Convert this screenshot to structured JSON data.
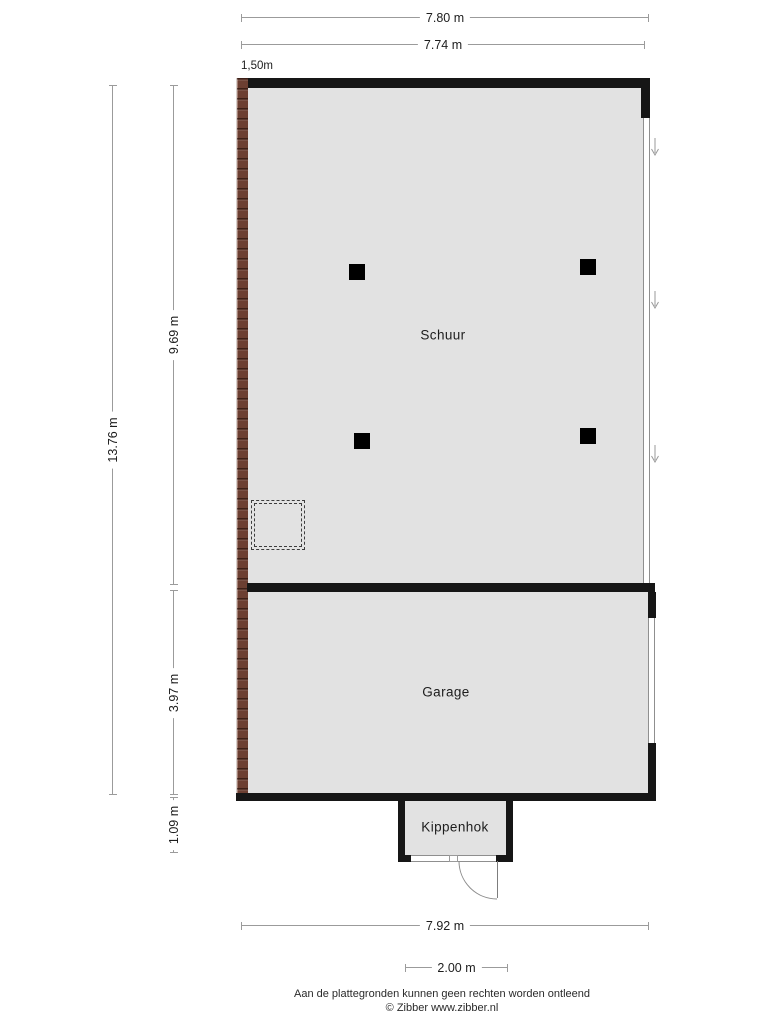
{
  "plan": {
    "rooms": [
      {
        "name": "Schuur"
      },
      {
        "name": "Garage"
      },
      {
        "name": "Kippenhok"
      }
    ],
    "wall_height_note": "1,50m",
    "dimensions": {
      "width_outer": "7.80 m",
      "width_inner": "7.74 m",
      "height_total": "13.76 m",
      "schuur_depth": "9.69 m",
      "garage_depth": "3.97 m",
      "kippenhok_depth": "1.09 m",
      "width_bottom": "7.92 m",
      "kippenhok_width": "2.00 m"
    }
  },
  "footer": {
    "disclaimer": "Aan de plattegronden kunnen geen rechten worden ontleend",
    "credit": "© Zibber www.zibber.nl"
  },
  "colors": {
    "floor": "#e2e2e2",
    "wall": "#161616",
    "brick": "#7b4839",
    "dimension_line": "#9b9b9b",
    "window": "#8f8f8f"
  }
}
